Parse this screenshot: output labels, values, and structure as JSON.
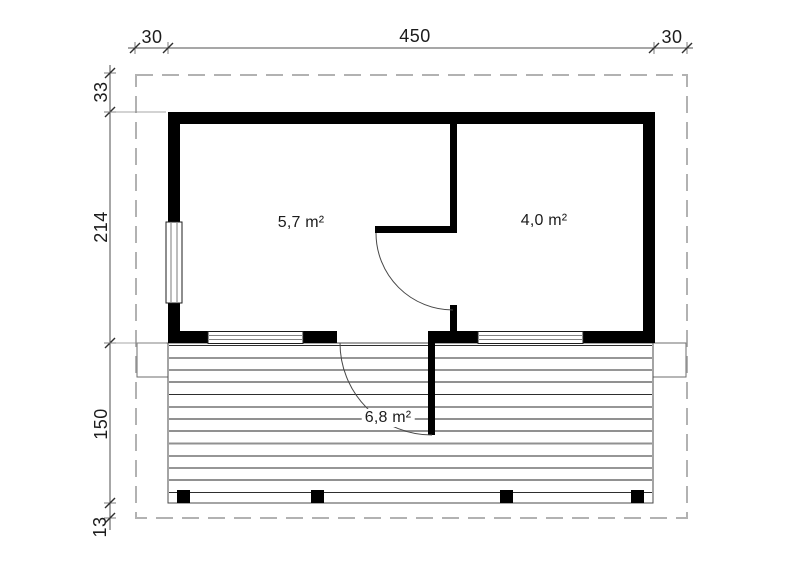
{
  "colors": {
    "wall": "#000000",
    "text": "#1c1c1c",
    "dim_line": "#4f4f4f",
    "roof_dash": "#b2b2b2",
    "deck_dark": "#2e2e2e",
    "deck_light": "#919191"
  },
  "dimensions": {
    "top": {
      "left": "30",
      "center": "450",
      "right": "30"
    },
    "side": {
      "top_offset": "33",
      "house_depth": "214",
      "terrace_depth": "150",
      "bottom_offset": "13"
    }
  },
  "areas": {
    "main_room": "5,7 m²",
    "side_room": "4,0 m²",
    "terrace": "6,8 m²"
  }
}
